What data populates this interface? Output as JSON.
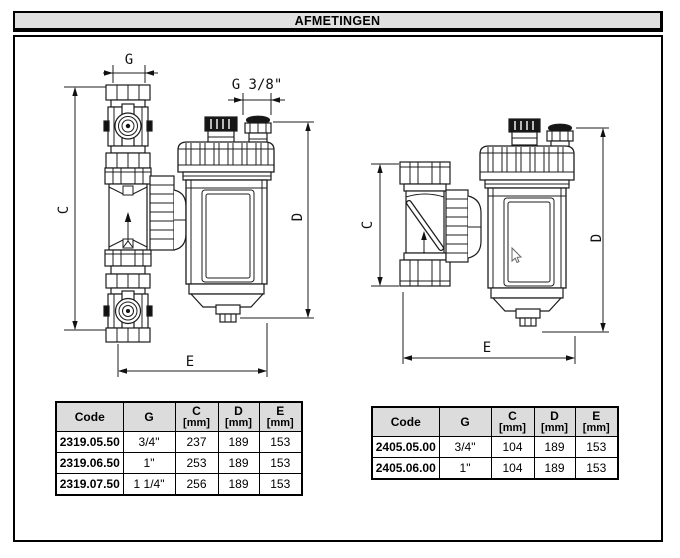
{
  "title": "AFMETINGEN",
  "colors": {
    "titlebar_bg": "#e0e0e0",
    "table_header_bg": "#dcdcdc",
    "line": "#1c1c1c"
  },
  "drawings": {
    "left": {
      "labels": {
        "g": "G",
        "g38": "G 3/8\"",
        "c": "C",
        "d": "D",
        "e": "E"
      }
    },
    "right": {
      "labels": {
        "c": "C",
        "d": "D",
        "e": "E"
      }
    }
  },
  "tables": {
    "left": {
      "headers": {
        "code": "Code",
        "g": "G",
        "c": "C",
        "d": "D",
        "e": "E",
        "unit": "[mm]"
      },
      "rows": [
        {
          "code": "2319.05.50",
          "g": "3/4\"",
          "c": "237",
          "d": "189",
          "e": "153"
        },
        {
          "code": "2319.06.50",
          "g": "1\"",
          "c": "253",
          "d": "189",
          "e": "153"
        },
        {
          "code": "2319.07.50",
          "g": "1 1/4\"",
          "c": "256",
          "d": "189",
          "e": "153"
        }
      ]
    },
    "right": {
      "headers": {
        "code": "Code",
        "g": "G",
        "c": "C",
        "d": "D",
        "e": "E",
        "unit": "[mm]"
      },
      "rows": [
        {
          "code": "2405.05.00",
          "g": "3/4\"",
          "c": "104",
          "d": "189",
          "e": "153"
        },
        {
          "code": "2405.06.00",
          "g": "1\"",
          "c": "104",
          "d": "189",
          "e": "153"
        }
      ]
    }
  }
}
